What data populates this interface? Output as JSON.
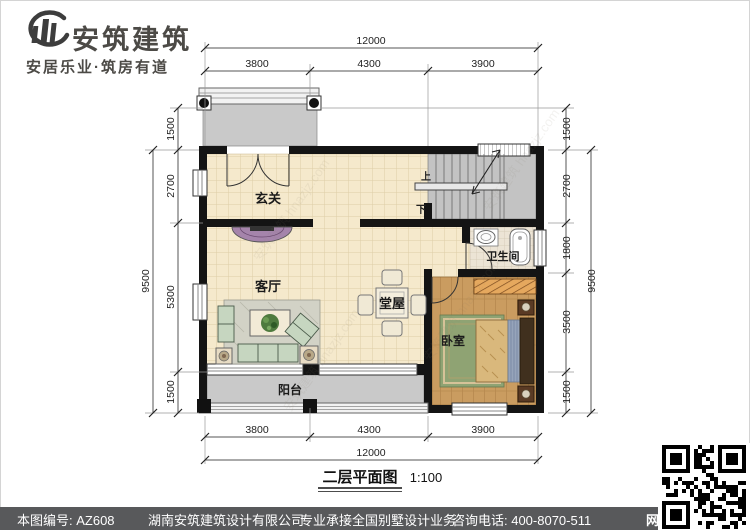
{
  "brand": {
    "title": "安筑建筑",
    "tagline": "安居乐业·筑房有道"
  },
  "plan": {
    "title": "二层平面图",
    "scale": "1:100",
    "rooms": {
      "entry": "玄关",
      "living": "客厅",
      "hall": "堂屋",
      "bedroom": "卧室",
      "bath": "卫生间",
      "balcony": "阳台"
    },
    "stairs": {
      "up": "上",
      "down": "下"
    },
    "dims": {
      "top": {
        "total": "12000",
        "segs": [
          "3800",
          "4300",
          "3900"
        ]
      },
      "bottom": {
        "total": "12000",
        "segs": [
          "3800",
          "4300",
          "3900"
        ]
      },
      "left": {
        "total": "9500",
        "segs": [
          "1500",
          "2700",
          "5300",
          "1500"
        ]
      },
      "right": {
        "total": "9500",
        "segs": [
          "1500",
          "2700",
          "1800",
          "3500",
          "1500"
        ]
      }
    }
  },
  "footer": {
    "number": "本图编号: AZ608",
    "company": "湖南安筑建筑设计有限公司",
    "service": "专业承接全国别墅设计业务",
    "phone": "咨询电话: 400-8070-511",
    "net": "网"
  },
  "watermark": "安筑建筑 hnazjz.com"
}
